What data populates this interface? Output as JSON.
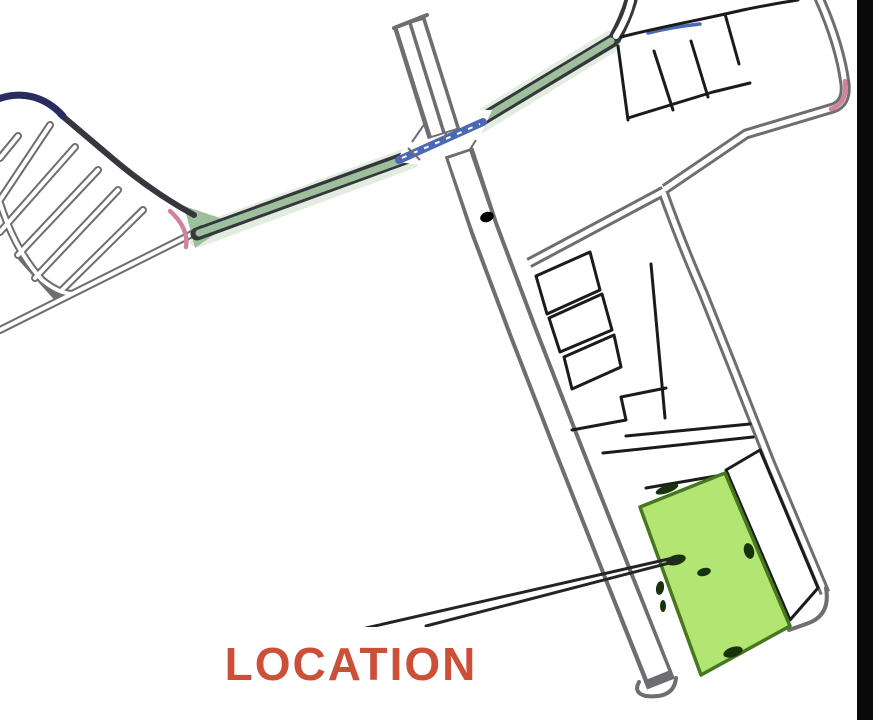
{
  "map": {
    "title": "site-location-plan",
    "label": {
      "text": "LOCATION",
      "color": "#cc4f38",
      "box_fill": "#ffffff",
      "box_border": "#3f3f3f"
    },
    "colors": {
      "background": "#ffffff",
      "road_edge": "#6d6d72",
      "road_dark": "#36363d",
      "road_white": "#ffffff",
      "navy": "#282c5e",
      "blue_marking": "#4a68b4",
      "green_road": "#9dbf9b",
      "green_road_halo": "#c9dfc2",
      "pink_accent": "#d2839b",
      "plot_line": "#1b1b1b",
      "plot_fill": "#ffffff",
      "plot_green": "#b3e573",
      "plot_green_edge": "#47771f",
      "mark_dark": "#17330c",
      "dot_black": "#000000",
      "leader": "#242424",
      "frame_strip": "#0a0a0a"
    }
  }
}
